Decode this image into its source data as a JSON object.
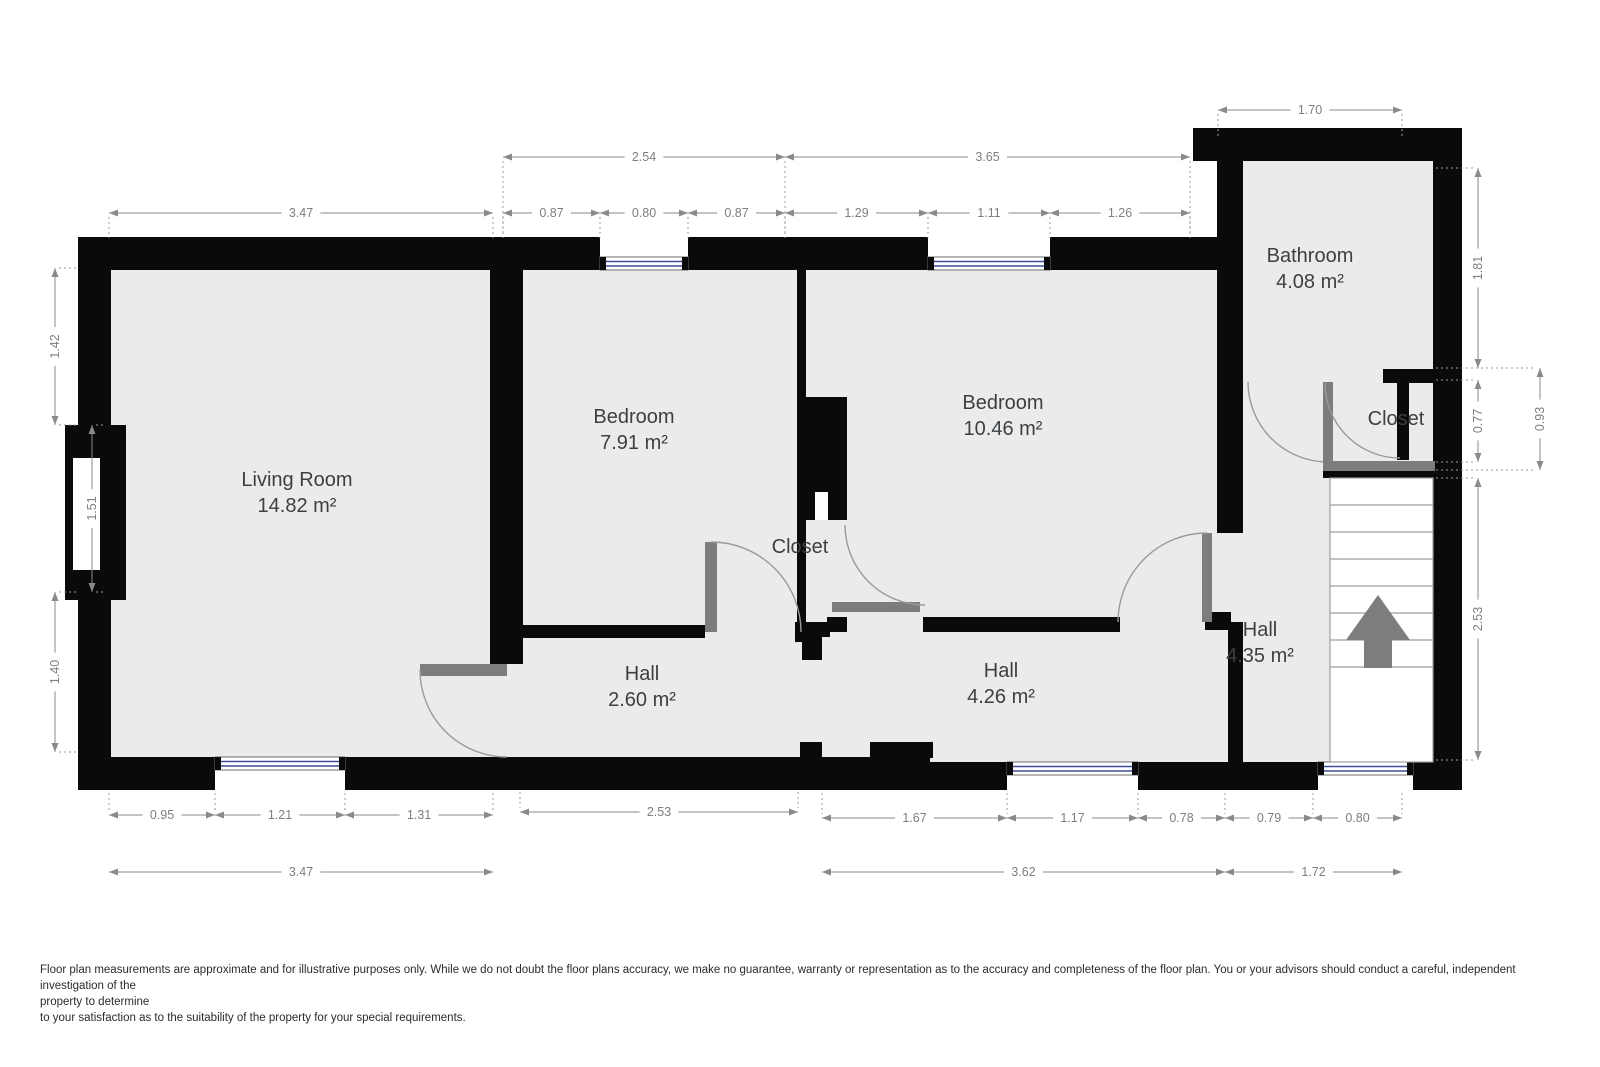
{
  "rooms": [
    {
      "name": "Living Room",
      "area": "14.82 m²"
    },
    {
      "name": "Bedroom",
      "area": "7.91 m²"
    },
    {
      "name": "Bedroom",
      "area": "10.46 m²"
    },
    {
      "name": "Bathroom",
      "area": "4.08 m²"
    },
    {
      "name": "Hall",
      "area": "2.60 m²"
    },
    {
      "name": "Hall",
      "area": "4.26 m²"
    },
    {
      "name": "Hall",
      "area": "4.35 m²"
    },
    {
      "name": "Closet"
    },
    {
      "name": "Closet"
    }
  ],
  "dimensions": {
    "top": [
      "1.70",
      "2.54",
      "3.65",
      "3.47",
      "0.87",
      "0.80",
      "0.87",
      "1.29",
      "1.11",
      "1.26"
    ],
    "left": [
      "1.42",
      "1.51",
      "1.40"
    ],
    "right": [
      "1.81",
      "0.77",
      "0.93",
      "2.53"
    ],
    "bottom": [
      "0.95",
      "1.21",
      "1.31",
      "2.53",
      "1.67",
      "1.17",
      "0.78",
      "0.79",
      "0.80",
      "3.47",
      "3.62",
      "1.72"
    ]
  },
  "stairs": {
    "direction": "up"
  },
  "colors": {
    "wall": "#0a0a0a",
    "floor": "#ebebeb",
    "door": "#7d7d7d",
    "window_glass": "#3d4d9a",
    "dimension": "#8a8a8a",
    "label": "#3c4043"
  },
  "disclaimer": {
    "line1": "Floor plan measurements are approximate and for illustrative purposes only. While we do not doubt the floor plans accuracy, we make no guarantee, warranty or representation as to the accuracy and completeness of the floor plan. You or your advisors should conduct a careful, independent investigation of the",
    "line2": "property to determine",
    "line3": " to your satisfaction as to the suitability of the property for your special requirements."
  }
}
